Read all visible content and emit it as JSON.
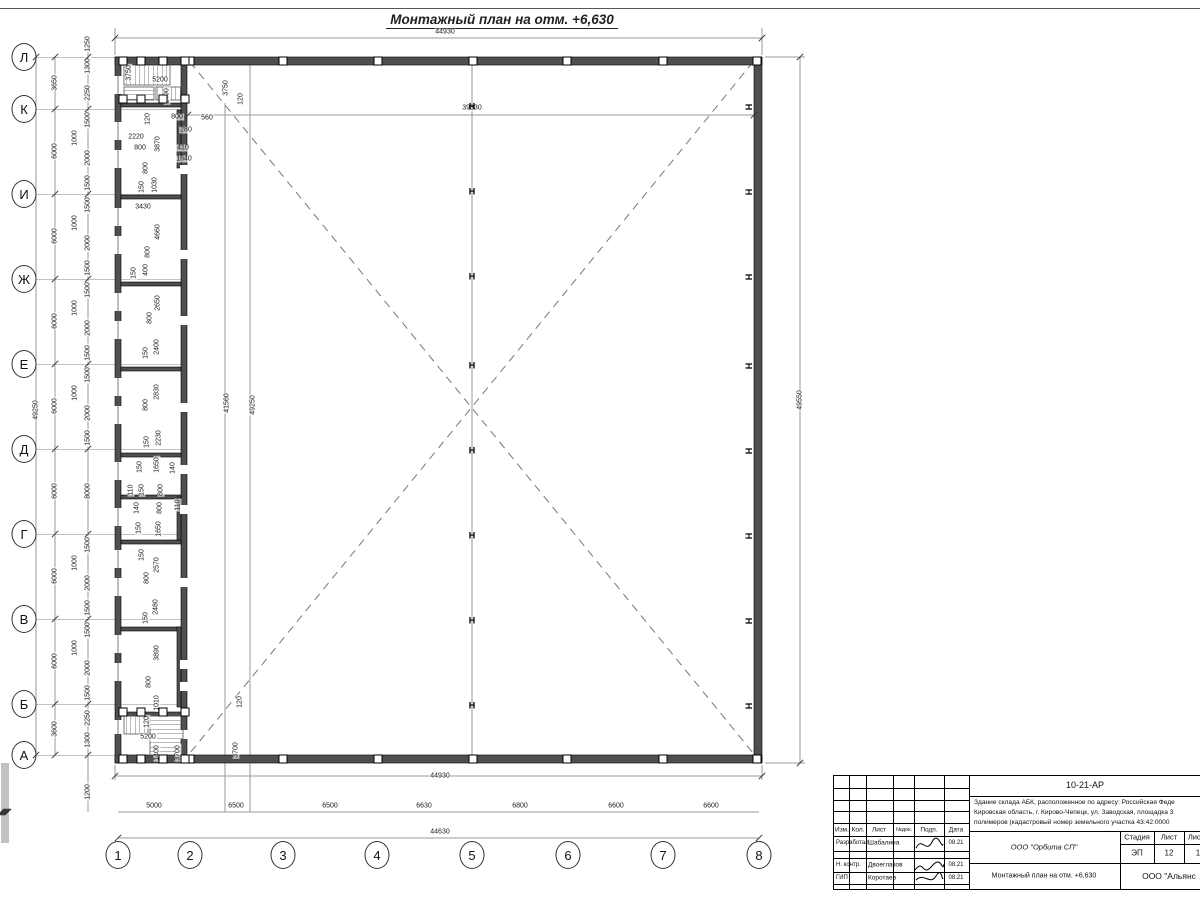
{
  "title": "Монтажный план на отм. +6,630",
  "colors": {
    "wall": "#4f4f4f",
    "dim_line": "#9a9a9a",
    "dash": "#777777",
    "text": "#1a1a1a"
  },
  "plan": {
    "axis_rows": [
      [
        "Л",
        57
      ],
      [
        "К",
        109
      ],
      [
        "И",
        194
      ],
      [
        "Ж",
        279
      ],
      [
        "Е",
        364
      ],
      [
        "Д",
        449
      ],
      [
        "Г",
        534
      ],
      [
        "В",
        619
      ],
      [
        "Б",
        704
      ],
      [
        "А",
        755
      ]
    ],
    "axis_cols": [
      [
        "1",
        118
      ],
      [
        "2",
        190
      ],
      [
        "3",
        283
      ],
      [
        "4",
        377
      ],
      [
        "5",
        472
      ],
      [
        "6",
        568
      ],
      [
        "7",
        663
      ],
      [
        "8",
        759
      ]
    ],
    "h_marker_ys": [
      107,
      192,
      277,
      366,
      451,
      536,
      621,
      706
    ],
    "h_center_x": 472,
    "h_right_x": 748,
    "h_glyph": "Н",
    "squares_top_xs": [
      190,
      283,
      378,
      473,
      567,
      663,
      757
    ],
    "square_top_y": 61,
    "square_bottom_y": 759,
    "squares_extra": [
      [
        123,
        61
      ],
      [
        141,
        61
      ],
      [
        163,
        61
      ],
      [
        185,
        61
      ],
      [
        123,
        99
      ],
      [
        141,
        99
      ],
      [
        163,
        99
      ],
      [
        185,
        99
      ],
      [
        123,
        712
      ],
      [
        141,
        712
      ],
      [
        163,
        712
      ],
      [
        185,
        712
      ],
      [
        123,
        759
      ],
      [
        141,
        759
      ],
      [
        163,
        759
      ],
      [
        185,
        759
      ]
    ],
    "dim_labels": [
      [
        "3650",
        55,
        83,
        "v"
      ],
      [
        "6000",
        55,
        151,
        "v"
      ],
      [
        "6000",
        55,
        236,
        "v"
      ],
      [
        "6000",
        55,
        321,
        "v"
      ],
      [
        "6000",
        55,
        406,
        "v"
      ],
      [
        "6000",
        55,
        491,
        "v"
      ],
      [
        "6000",
        55,
        576,
        "v"
      ],
      [
        "6000",
        55,
        661,
        "v"
      ],
      [
        "3600",
        55,
        729,
        "v"
      ],
      [
        "49250",
        36,
        410,
        "v"
      ],
      [
        "1250",
        88,
        44,
        "v"
      ],
      [
        "1300",
        88,
        66,
        "v"
      ],
      [
        "2250",
        88,
        93,
        "v"
      ],
      [
        "1500",
        88,
        120,
        "v"
      ],
      [
        "1000",
        75,
        138,
        "v"
      ],
      [
        "2000",
        88,
        158,
        "v"
      ],
      [
        "1500",
        88,
        183,
        "v"
      ],
      [
        "1500",
        88,
        205,
        "v"
      ],
      [
        "1000",
        75,
        223,
        "v"
      ],
      [
        "2000",
        88,
        243,
        "v"
      ],
      [
        "1500",
        88,
        268,
        "v"
      ],
      [
        "1500",
        88,
        290,
        "v"
      ],
      [
        "1000",
        75,
        308,
        "v"
      ],
      [
        "2000",
        88,
        328,
        "v"
      ],
      [
        "1500",
        88,
        353,
        "v"
      ],
      [
        "1500",
        88,
        375,
        "v"
      ],
      [
        "1000",
        75,
        393,
        "v"
      ],
      [
        "2000",
        88,
        413,
        "v"
      ],
      [
        "1500",
        88,
        438,
        "v"
      ],
      [
        "8000",
        88,
        491,
        "v"
      ],
      [
        "1500",
        88,
        545,
        "v"
      ],
      [
        "1000",
        75,
        563,
        "v"
      ],
      [
        "2000",
        88,
        583,
        "v"
      ],
      [
        "1500",
        88,
        608,
        "v"
      ],
      [
        "1500",
        88,
        630,
        "v"
      ],
      [
        "1000",
        75,
        648,
        "v"
      ],
      [
        "2000",
        88,
        668,
        "v"
      ],
      [
        "1500",
        88,
        693,
        "v"
      ],
      [
        "2250",
        88,
        718,
        "v"
      ],
      [
        "1300",
        88,
        740,
        "v"
      ],
      [
        "1200",
        88,
        792,
        "v"
      ],
      [
        "3750",
        129,
        73,
        "v"
      ],
      [
        "5200",
        160,
        80,
        "h"
      ],
      [
        "1400",
        167,
        96,
        "v"
      ],
      [
        "120",
        148,
        119,
        "v"
      ],
      [
        "800",
        177,
        117,
        "h"
      ],
      [
        "560",
        207,
        118,
        "h"
      ],
      [
        "280",
        186,
        130,
        "h"
      ],
      [
        "2220",
        136,
        137,
        "h"
      ],
      [
        "800",
        140,
        148,
        "h"
      ],
      [
        "3870",
        158,
        144,
        "v"
      ],
      [
        "410",
        183,
        148,
        "h"
      ],
      [
        "1640",
        184,
        159,
        "h"
      ],
      [
        "800",
        146,
        168,
        "v"
      ],
      [
        "3750",
        226,
        88,
        "v"
      ],
      [
        "120",
        241,
        99,
        "v"
      ],
      [
        "150",
        142,
        187,
        "v"
      ],
      [
        "1030",
        155,
        185,
        "v"
      ],
      [
        "3430",
        143,
        207,
        "h"
      ],
      [
        "4660",
        158,
        232,
        "v"
      ],
      [
        "800",
        148,
        252,
        "v"
      ],
      [
        "400",
        146,
        270,
        "v"
      ],
      [
        "150",
        134,
        273,
        "v"
      ],
      [
        "2650",
        158,
        303,
        "v"
      ],
      [
        "800",
        150,
        318,
        "v"
      ],
      [
        "2400",
        157,
        347,
        "v"
      ],
      [
        "150",
        146,
        353,
        "v"
      ],
      [
        "2830",
        157,
        392,
        "v"
      ],
      [
        "800",
        146,
        405,
        "v"
      ],
      [
        "2230",
        159,
        438,
        "v"
      ],
      [
        "150",
        147,
        442,
        "v"
      ],
      [
        "1650",
        157,
        465,
        "v"
      ],
      [
        "150",
        140,
        467,
        "v"
      ],
      [
        "140",
        173,
        468,
        "v"
      ],
      [
        "110",
        131,
        490,
        "v"
      ],
      [
        "150",
        142,
        490,
        "v"
      ],
      [
        "800",
        161,
        490,
        "v"
      ],
      [
        "140",
        137,
        508,
        "v"
      ],
      [
        "800",
        160,
        508,
        "v"
      ],
      [
        "110",
        178,
        505,
        "v"
      ],
      [
        "150",
        139,
        528,
        "v"
      ],
      [
        "1650",
        159,
        529,
        "v"
      ],
      [
        "150",
        142,
        555,
        "v"
      ],
      [
        "2570",
        157,
        565,
        "v"
      ],
      [
        "800",
        147,
        578,
        "v"
      ],
      [
        "2480",
        156,
        607,
        "v"
      ],
      [
        "150",
        146,
        618,
        "v"
      ],
      [
        "3890",
        157,
        653,
        "v"
      ],
      [
        "800",
        149,
        682,
        "v"
      ],
      [
        "1010",
        157,
        703,
        "v"
      ],
      [
        "120",
        147,
        722,
        "v"
      ],
      [
        "5200",
        148,
        737,
        "h"
      ],
      [
        "1400",
        157,
        753,
        "v"
      ],
      [
        "3700",
        178,
        753,
        "v"
      ],
      [
        "120",
        240,
        702,
        "v"
      ],
      [
        "3700",
        236,
        750,
        "v"
      ],
      [
        "41560",
        227,
        403,
        "v"
      ],
      [
        "49250",
        253,
        405,
        "v"
      ],
      [
        "39330",
        472,
        108,
        "h"
      ],
      [
        "44930",
        445,
        32,
        "h"
      ],
      [
        "44930",
        440,
        776,
        "h"
      ],
      [
        "49550",
        800,
        400,
        "v"
      ],
      [
        "5000",
        154,
        806,
        "h"
      ],
      [
        "6500",
        236,
        806,
        "h"
      ],
      [
        "6500",
        330,
        806,
        "h"
      ],
      [
        "6630",
        424,
        806,
        "h"
      ],
      [
        "6800",
        520,
        806,
        "h"
      ],
      [
        "6600",
        616,
        806,
        "h"
      ],
      [
        "6600",
        711,
        806,
        "h"
      ],
      [
        "44630",
        440,
        832,
        "h"
      ]
    ]
  },
  "title_block": {
    "code": "10-21-АР",
    "desc1": "Здание склада АБК, расположенное по адресу: Российская Феде",
    "desc2": "Кировская область, г. Кирово-Чепецк, ул. Заводская, площадка 3",
    "desc3": "полимеров (кадастровый номер земельного участка 43:42:0000",
    "headers": {
      "izm": "Изм.",
      "kol": "Кол.",
      "list": "Лист",
      "ndok": "№док.",
      "podp": "Подп.",
      "data": "Дата"
    },
    "row1_role": "Разработал",
    "row1_name": "Шабалина",
    "row1_date": "08.21",
    "row2_role": "Н. контр.",
    "row2_name": "Двоеглазов",
    "row2_date": "08.21",
    "row3_role": "ГИП",
    "row3_name": "Коротаев",
    "row3_date": "08.21",
    "org": "ООО \"Орбита СП\"",
    "stage_label": "Стадия",
    "sheet_label": "Лист",
    "sheets_label": "Листов",
    "stage": "ЭП",
    "sheet": "12",
    "sheets": "1",
    "drawing_name": "Монтажный план на отм. +6,630",
    "company": "ООО \"Альянс"
  }
}
